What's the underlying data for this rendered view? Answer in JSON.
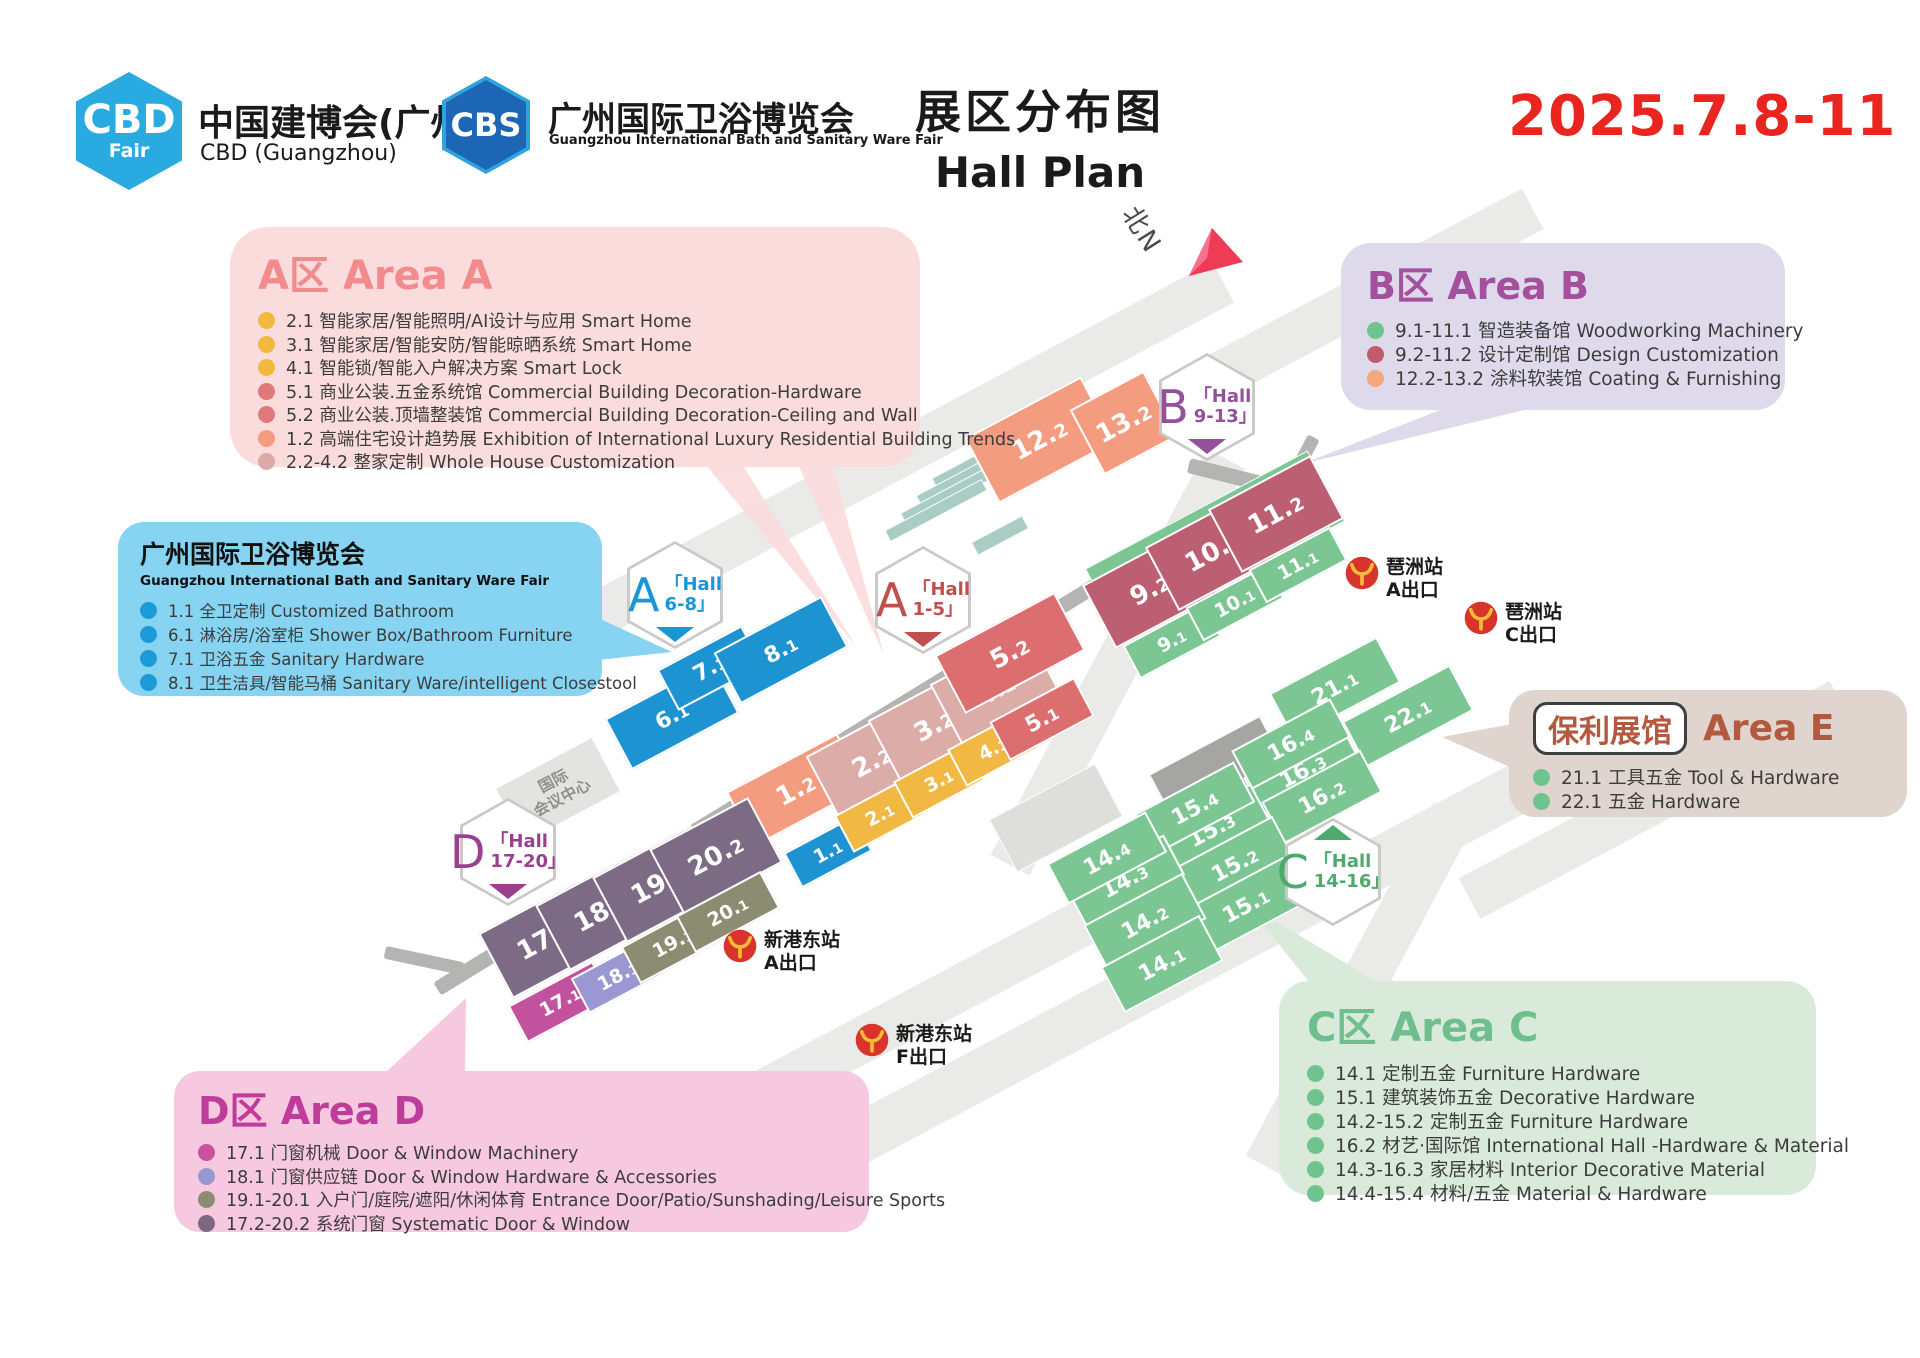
{
  "header": {
    "cbd_logo": {
      "abbr": "CBD",
      "sub": "Fair",
      "title": "中国建博会(广州)",
      "subtitle": "CBD (Guangzhou)"
    },
    "cbs_logo": {
      "abbr": "CBS",
      "title": "广州国际卫浴博览会",
      "subtitle": "Guangzhou International Bath and Sanitary Ware Fair"
    },
    "title_cn": "展区分布图",
    "title_en": "Hall Plan",
    "date": "2025.7.8-11"
  },
  "callouts": {
    "areaA": {
      "title": "A区 Area A",
      "accent": "#F28B8D",
      "bg": "#FBDCDD",
      "items": [
        {
          "dot": "#F2B93F",
          "text": "2.1 智能家居/智能照明/AI设计与应用 Smart Home"
        },
        {
          "dot": "#F2B93F",
          "text": "3.1 智能家居/智能安防/智能晾晒系统 Smart Home"
        },
        {
          "dot": "#F2B93F",
          "text": "4.1 智能锁/智能入户解决方案 Smart Lock"
        },
        {
          "dot": "#E0797B",
          "text": "5.1 商业公装.五金系统馆 Commercial Building Decoration-Hardware"
        },
        {
          "dot": "#E0797B",
          "text": "5.2 商业公装.顶墙整装馆 Commercial Building Decoration-Ceiling and Wall"
        },
        {
          "dot": "#F49C80",
          "text": "1.2 高端住宅设计趋势展 Exhibition of International Luxury Residential Building Trends"
        },
        {
          "dot": "#DCABA8",
          "text": "2.2-4.2 整家定制 Whole House Customization"
        }
      ]
    },
    "bath": {
      "title": "广州国际卫浴博览会",
      "subtitle": "Guangzhou International Bath and Sanitary Ware Fair",
      "bg": "#86D3F2",
      "items": [
        {
          "dot": "#1B9CD9",
          "text": "1.1 全卫定制 Customized Bathroom"
        },
        {
          "dot": "#1B9CD9",
          "text": "6.1 淋浴房/浴室柜 Shower Box/Bathroom Furniture"
        },
        {
          "dot": "#1B9CD9",
          "text": "7.1 卫浴五金 Sanitary Hardware"
        },
        {
          "dot": "#1B9CD9",
          "text": "8.1 卫生洁具/智能马桶 Sanitary Ware/intelligent Closestool"
        }
      ]
    },
    "areaB": {
      "title": "B区 Area B",
      "accent": "#A5509C",
      "bg": "#DEDAEC",
      "items": [
        {
          "dot": "#6FC38E",
          "text": "9.1-11.1 智造装备馆 Woodworking Machinery"
        },
        {
          "dot": "#C25B6C",
          "text": "9.2-11.2 设计定制馆 Design Customization"
        },
        {
          "dot": "#F5A77F",
          "text": "12.2-13.2 涂料软装馆 Coating & Furnishing"
        }
      ]
    },
    "areaE": {
      "badge": "保利展馆",
      "title": "Area E",
      "accent": "#B2593F",
      "bg": "#DFD5CE",
      "items": [
        {
          "dot": "#6FC38E",
          "text": "21.1 工具五金 Tool & Hardware"
        },
        {
          "dot": "#6FC38E",
          "text": "22.1 五金 Hardware"
        }
      ]
    },
    "areaC": {
      "title": "C区 Area C",
      "accent": "#6FBE8D",
      "bg": "#D9EADB",
      "items": [
        {
          "dot": "#6FC38E",
          "text": "14.1 定制五金 Furniture Hardware"
        },
        {
          "dot": "#6FC38E",
          "text": "15.1 建筑装饰五金 Decorative Hardware"
        },
        {
          "dot": "#6FC38E",
          "text": "14.2-15.2 定制五金 Furniture Hardware"
        },
        {
          "dot": "#6FC38E",
          "text": "16.2 材艺·国际馆 International Hall -Hardware & Material"
        },
        {
          "dot": "#6FC38E",
          "text": "14.3-16.3 家居材料 Interior Decorative Material"
        },
        {
          "dot": "#6FC38E",
          "text": "14.4-15.4 材料/五金 Material & Hardware"
        }
      ]
    },
    "areaD": {
      "title": "D区 Area D",
      "accent": "#BE3D9A",
      "bg": "#F6C9E1",
      "items": [
        {
          "dot": "#C9519E",
          "text": "17.1 门窗机械 Door & Window Machinery"
        },
        {
          "dot": "#9898D0",
          "text": "18.1 门窗供应链 Door & Window Hardware & Accessories"
        },
        {
          "dot": "#8C8C72",
          "text": "19.1-20.1 入户门/庭院/遮阳/休闲体育 Entrance Door/Patio/Sunshading/Leisure Sports"
        },
        {
          "dot": "#7C6880",
          "text": "17.2-20.2 系统门窗 Systematic Door & Window"
        }
      ]
    }
  },
  "map": {
    "colors": {
      "blue": "#1E93D2",
      "salmon": "#F49C80",
      "dusty": "#DCACA9",
      "yellow": "#F2B844",
      "red": "#DD6E70",
      "rose": "#BC5F72",
      "green": "#7CC694",
      "purple": "#7D6B85",
      "magenta": "#C2519E",
      "periwinkle": "#9B97D2",
      "olive": "#8C8C72",
      "teal": "#A9CDC4",
      "gray": "#A5A5A3",
      "lightgray": "#DEDEDC"
    },
    "compass": "北N",
    "building": {
      "line1": "国际",
      "line2": "会议中心"
    },
    "badges": [
      {
        "letter": "A",
        "line1": "「Hall",
        "line2": "6-8」",
        "color": "#1B96D5",
        "x": 675,
        "y": 595,
        "tri": "bottom"
      },
      {
        "letter": "A",
        "line1": "「Hall",
        "line2": "1-5」",
        "color": "#C0504D",
        "x": 923,
        "y": 600,
        "tri": "bottom"
      },
      {
        "letter": "B",
        "line1": "「Hall",
        "line2": "9-13」",
        "color": "#94519B",
        "x": 1207,
        "y": 407,
        "tri": "bottom"
      },
      {
        "letter": "C",
        "line1": "「Hall",
        "line2": "14-16」",
        "color": "#4FA96E",
        "x": 1333,
        "y": 872,
        "tri": "top"
      },
      {
        "letter": "D",
        "line1": "「Hall",
        "line2": "17-20」",
        "color": "#9C3F8F",
        "x": 508,
        "y": 852,
        "tri": "bottom"
      }
    ],
    "stations": [
      {
        "name": "琶洲站",
        "exit": "A出口",
        "x": 1345,
        "y": 556
      },
      {
        "name": "琶洲站",
        "exit": "C出口",
        "x": 1464,
        "y": 601
      },
      {
        "name": "新港东站",
        "exit": "A出口",
        "x": 723,
        "y": 929
      },
      {
        "name": "新港东站",
        "exit": "F出口",
        "x": 855,
        "y": 1023
      }
    ],
    "blocks": [
      {
        "t": "deco",
        "x": 1215,
        "y": 545,
        "w": 252,
        "h": 80,
        "c": "green"
      },
      {
        "t": "deco",
        "x": 1218,
        "y": 772,
        "w": 125,
        "h": 60,
        "c": "gray"
      },
      {
        "t": "deco",
        "x": 1056,
        "y": 818,
        "w": 120,
        "h": 60,
        "c": "lightgray"
      },
      {
        "t": "deco",
        "x": 975,
        "y": 462,
        "w": 92,
        "h": 13,
        "c": "teal"
      },
      {
        "t": "deco",
        "x": 962,
        "y": 478,
        "w": 98,
        "h": 13,
        "c": "teal"
      },
      {
        "t": "deco",
        "x": 949,
        "y": 494,
        "w": 104,
        "h": 13,
        "c": "teal"
      },
      {
        "t": "deco",
        "x": 936,
        "y": 510,
        "w": 110,
        "h": 13,
        "c": "teal"
      },
      {
        "t": "deco",
        "x": 1000,
        "y": 535,
        "w": 58,
        "h": 15,
        "c": "teal"
      },
      {
        "t": "building",
        "x": 558,
        "y": 790,
        "w": 112,
        "h": 64
      },
      {
        "id": "6.1",
        "x": 672,
        "y": 716,
        "w": 122,
        "h": 58,
        "c": "blue"
      },
      {
        "id": "7.1",
        "x": 710,
        "y": 668,
        "w": 96,
        "h": 46,
        "c": "blue"
      },
      {
        "id": "8.1",
        "x": 781,
        "y": 650,
        "w": 122,
        "h": 58,
        "c": "blue"
      },
      {
        "id": "1.1",
        "x": 828,
        "y": 852,
        "w": 80,
        "h": 40,
        "c": "blue"
      },
      {
        "id": "1.2",
        "x": 796,
        "y": 790,
        "w": 126,
        "h": 62,
        "c": "salmon"
      },
      {
        "id": "2.2",
        "x": 872,
        "y": 762,
        "w": 112,
        "h": 72,
        "c": "dusty"
      },
      {
        "id": "3.2",
        "x": 934,
        "y": 726,
        "w": 112,
        "h": 72,
        "c": "dusty"
      },
      {
        "id": "4.2",
        "x": 996,
        "y": 690,
        "w": 112,
        "h": 72,
        "c": "dusty"
      },
      {
        "id": "2.1",
        "x": 880,
        "y": 815,
        "w": 82,
        "h": 42,
        "c": "yellow"
      },
      {
        "id": "3.1",
        "x": 939,
        "y": 781,
        "w": 82,
        "h": 42,
        "c": "yellow"
      },
      {
        "id": "4.1",
        "x": 993,
        "y": 749,
        "w": 82,
        "h": 42,
        "c": "yellow"
      },
      {
        "id": "5.2",
        "x": 1010,
        "y": 653,
        "w": 136,
        "h": 66,
        "c": "red"
      },
      {
        "id": "5.1",
        "x": 1042,
        "y": 719,
        "w": 96,
        "h": 44,
        "c": "red"
      },
      {
        "id": "12.2",
        "x": 1040,
        "y": 440,
        "w": 132,
        "h": 74,
        "c": "salmon"
      },
      {
        "id": "13.2",
        "x": 1124,
        "y": 423,
        "w": 84,
        "h": 74,
        "c": "salmon"
      },
      {
        "id": "9.2",
        "x": 1150,
        "y": 590,
        "w": 116,
        "h": 72,
        "c": "rose"
      },
      {
        "id": "10.2",
        "x": 1213,
        "y": 552,
        "w": 116,
        "h": 72,
        "c": "rose"
      },
      {
        "id": "11.2",
        "x": 1276,
        "y": 514,
        "w": 116,
        "h": 72,
        "c": "rose"
      },
      {
        "id": "9.1",
        "x": 1172,
        "y": 641,
        "w": 92,
        "h": 38,
        "c": "green"
      },
      {
        "id": "10.1",
        "x": 1235,
        "y": 603,
        "w": 92,
        "h": 38,
        "c": "green"
      },
      {
        "id": "11.1",
        "x": 1298,
        "y": 565,
        "w": 92,
        "h": 38,
        "c": "green"
      },
      {
        "id": "21.1",
        "x": 1335,
        "y": 688,
        "w": 122,
        "h": 52,
        "c": "green"
      },
      {
        "id": "22.1",
        "x": 1408,
        "y": 716,
        "w": 122,
        "h": 52,
        "c": "green"
      },
      {
        "id": "16.3",
        "x": 1303,
        "y": 771,
        "w": 112,
        "h": 44,
        "c": "green"
      },
      {
        "id": "16.4",
        "x": 1291,
        "y": 744,
        "w": 112,
        "h": 44,
        "c": "green"
      },
      {
        "id": "16.2",
        "x": 1322,
        "y": 797,
        "w": 112,
        "h": 48,
        "c": "green"
      },
      {
        "id": "15.3",
        "x": 1212,
        "y": 830,
        "w": 112,
        "h": 46,
        "c": "green"
      },
      {
        "id": "15.4",
        "x": 1195,
        "y": 808,
        "w": 112,
        "h": 46,
        "c": "green"
      },
      {
        "id": "15.2",
        "x": 1235,
        "y": 865,
        "w": 112,
        "h": 52,
        "c": "green"
      },
      {
        "id": "15.1",
        "x": 1246,
        "y": 906,
        "w": 112,
        "h": 52,
        "c": "green"
      },
      {
        "id": "14.3",
        "x": 1125,
        "y": 881,
        "w": 112,
        "h": 46,
        "c": "green"
      },
      {
        "id": "14.4",
        "x": 1107,
        "y": 858,
        "w": 112,
        "h": 46,
        "c": "green"
      },
      {
        "id": "14.2",
        "x": 1145,
        "y": 922,
        "w": 112,
        "h": 52,
        "c": "green"
      },
      {
        "id": "14.1",
        "x": 1162,
        "y": 964,
        "w": 112,
        "h": 52,
        "c": "green"
      },
      {
        "id": "17.2",
        "x": 545,
        "y": 940,
        "w": 112,
        "h": 74,
        "c": "purple"
      },
      {
        "id": "18.2",
        "x": 602,
        "y": 912,
        "w": 112,
        "h": 74,
        "c": "purple"
      },
      {
        "id": "19.2",
        "x": 659,
        "y": 884,
        "w": 112,
        "h": 74,
        "c": "purple"
      },
      {
        "id": "20.2",
        "x": 716,
        "y": 856,
        "w": 112,
        "h": 74,
        "c": "purple"
      },
      {
        "id": "17.1",
        "x": 560,
        "y": 1002,
        "w": 96,
        "h": 42,
        "c": "magenta"
      },
      {
        "id": "18.1",
        "x": 618,
        "y": 976,
        "w": 86,
        "h": 40,
        "c": "periwinkle"
      },
      {
        "id": "19.1",
        "x": 673,
        "y": 943,
        "w": 96,
        "h": 42,
        "c": "olive"
      },
      {
        "id": "20.1",
        "x": 728,
        "y": 912,
        "w": 96,
        "h": 42,
        "c": "olive"
      }
    ]
  }
}
